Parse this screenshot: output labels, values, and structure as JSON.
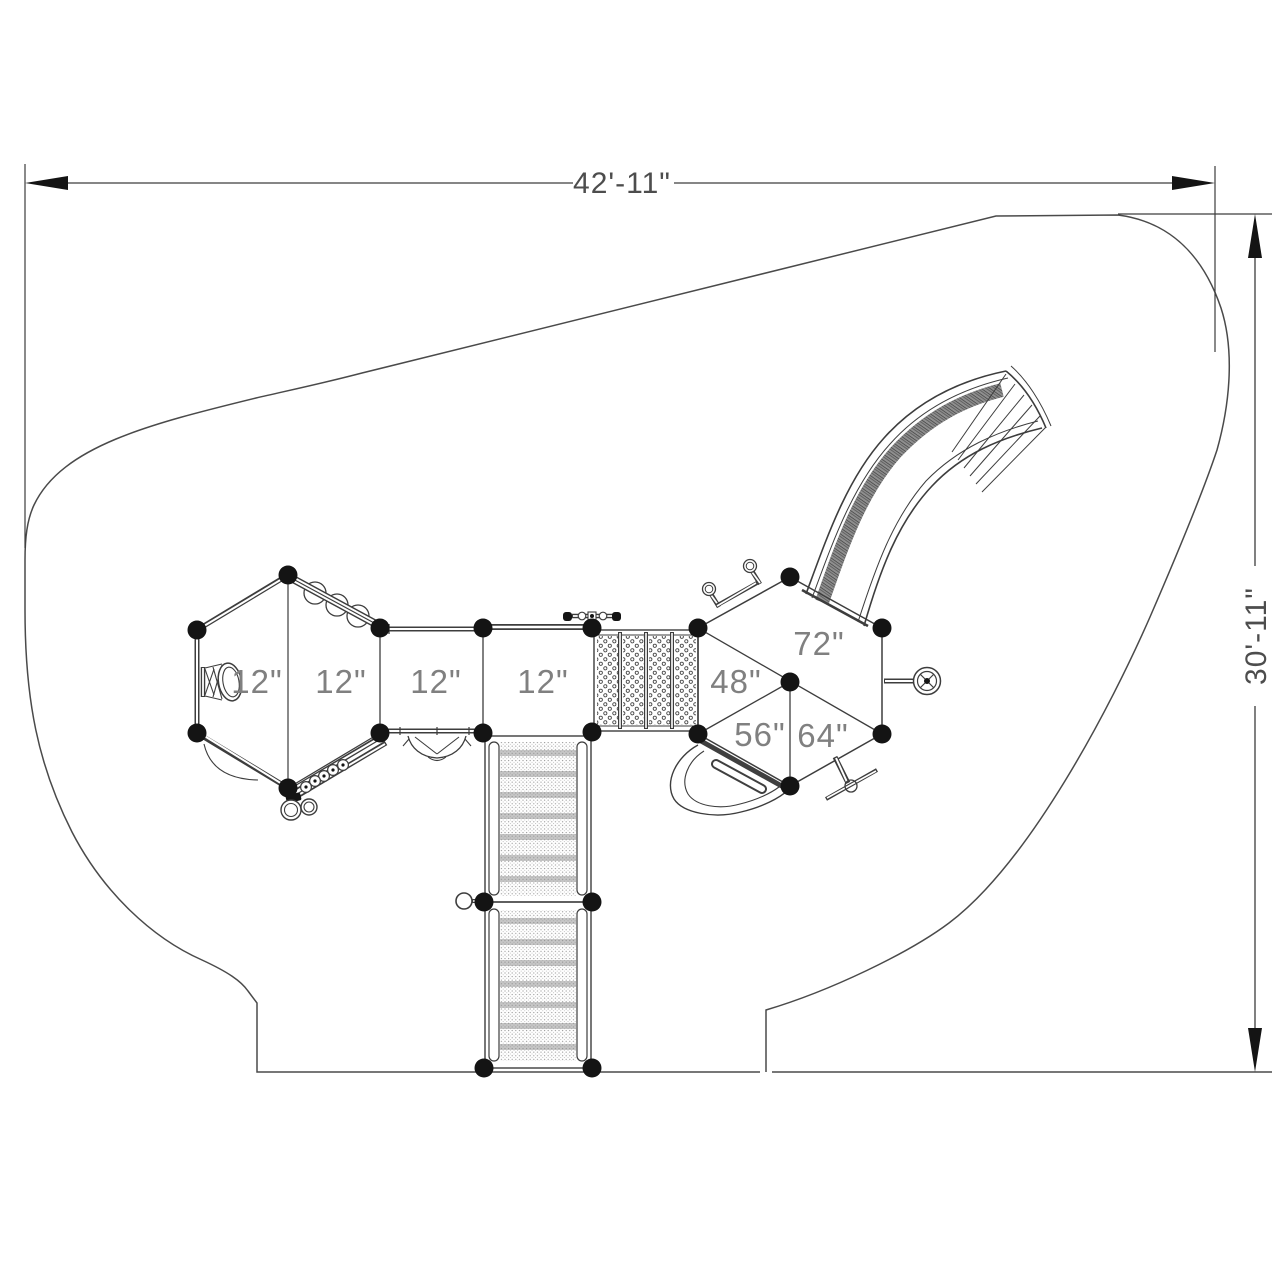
{
  "labels": {
    "dim_width": "42'-11\"",
    "dim_height": "30'-11\"",
    "deck1": "12\"",
    "deck2": "12\"",
    "deck3": "12\"",
    "deck4": "12\"",
    "deck48": "48\"",
    "deck72": "72\"",
    "deck56": "56\"",
    "deck64": "64\""
  },
  "colors": {
    "line": "#3d3d3d",
    "boundary": "#4a4a4a",
    "label": "#808080",
    "dim": "#4d4d4d",
    "post": "#141414",
    "bg": "#ffffff"
  }
}
